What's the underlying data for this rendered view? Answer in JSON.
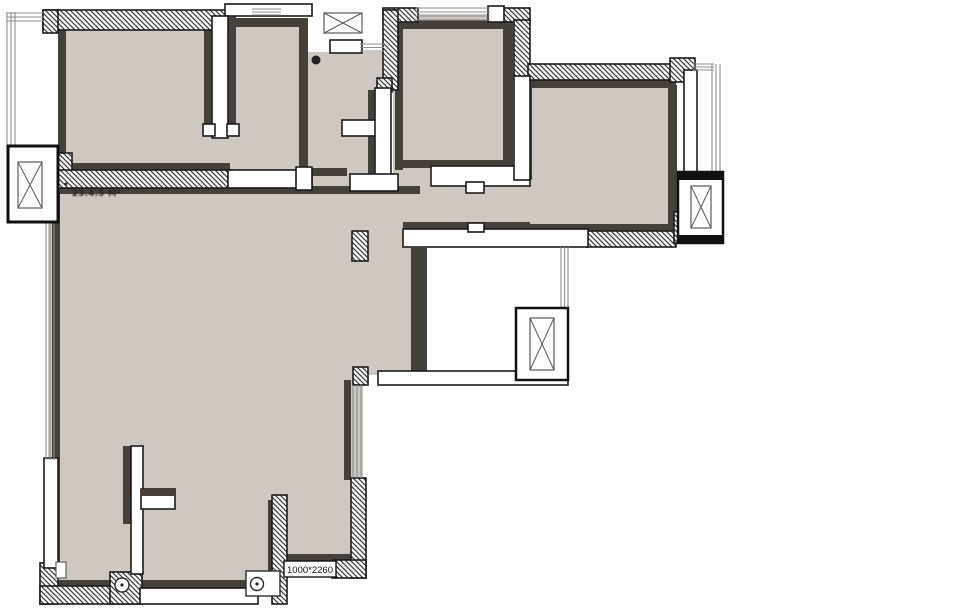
{
  "document": {
    "type": "architectural-floor-plan",
    "background": "#ffffff"
  },
  "palette": {
    "floor": "#cfc8c1",
    "trim": "#45413a",
    "wall_outline": "#1c1c1c",
    "hatch_line": "#3f3f3f",
    "window_line": "#8f8f8f"
  },
  "labels": {
    "door_dimension": "1000*2260",
    "stamp": "23.4.5 M²"
  },
  "symbols": {
    "shaft_icons": [
      {
        "name": "top-center-shaft-cross-icon"
      },
      {
        "name": "left-elevator-cross-icon"
      },
      {
        "name": "right-elevator-cross-icon"
      },
      {
        "name": "center-elevator-cross-icon"
      }
    ],
    "fixture_icons": [
      {
        "name": "door-pivot-dot-icon"
      },
      {
        "name": "drain-circle-icon"
      },
      {
        "name": "drain-circle-small-icon"
      },
      {
        "name": "pipe-rect-icon"
      }
    ]
  }
}
